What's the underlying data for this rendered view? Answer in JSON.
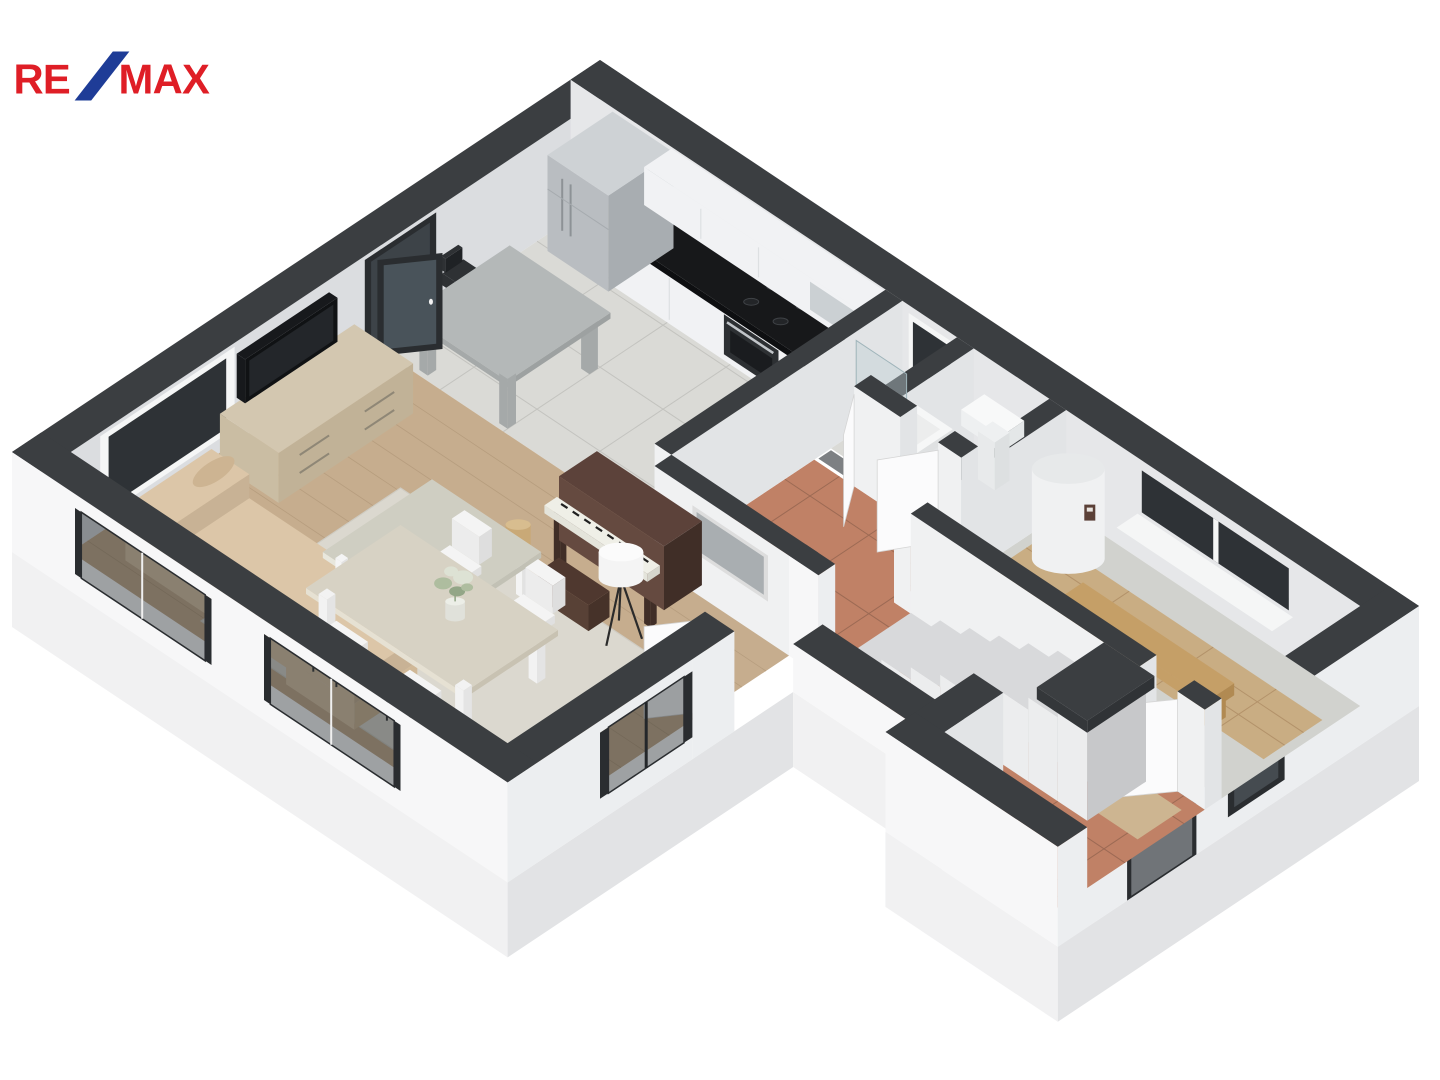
{
  "page": {
    "background": "#ffffff",
    "type": "3d-floorplan-render"
  },
  "logo": {
    "re": "RE",
    "slash": "/",
    "max": "MAX",
    "red": "#df1e26",
    "blue": "#1e3c97"
  },
  "palette": {
    "bg": "#ffffff",
    "wall_cap": "#3b3e41",
    "int_sw": "#f0f1f2",
    "int_se": "#e2e4e6",
    "inner_back_sw": "#e6e7e9",
    "inner_back_se": "#dbdde0",
    "out_sw": "#f7f7f8",
    "out_se": "#eceef0",
    "slab_sw": "#f1f1f2",
    "slab_se": "#e2e3e5",
    "glass": "#2e3236",
    "glass_tint": "rgba(24,30,35,0.42)",
    "frame_white": "#f5f6f6",
    "door_frame": "#2a2d30",
    "floor_tile": "#dadad6",
    "tile_grout": "#c3c3bf",
    "terracotta": "#c08166",
    "terracotta_grout": "#9c6a54",
    "wood": "#c6ad8e",
    "wood_line": "#b69d7e",
    "concrete": "#d1d2ce",
    "wood_path": "#c9ad83",
    "wood_path_line": "#b3926a",
    "stair_top": "#d8d9db",
    "stair_face": "#ecedee",
    "stair_side": "#c7c8ca",
    "counter_black": "#17181a",
    "counter_face": "#0e0f11",
    "cabinet": "#f1f2f4",
    "cabinet_seam": "#dde0e2",
    "steel": "#b9bdc1",
    "steel_side": "#a8adb1",
    "steel_top": "#ced2d5",
    "island": "#b4b8b8",
    "island_side": "#a5a9a9",
    "stool_dark": "#2e3134",
    "chrome": "#c6cacd",
    "sofa": "#dcc6a8",
    "sofa_dark": "#d0b897",
    "sofa_roll": "#cdb492",
    "rug": "#dbd8cf",
    "rug_edge": "#cfccc3",
    "table_pale": "#d7d2c4",
    "table_edge": "#c8c2b2",
    "coffee": "#cfcec2",
    "leg_white": "#f4f4f4",
    "dresser": "#d3c7b0",
    "dresser_face": "#cabda3",
    "dresser_end": "#c1b297",
    "handle": "#8f8776",
    "tv": "#17191c",
    "tv_screen": "#23262a",
    "piano": "#5c423a",
    "piano_face": "#654a40",
    "piano_dark": "#402e27",
    "keys": "#efefe7",
    "bench": "#4f382f",
    "lamp": "#f4f4f4",
    "shelf": "#c59f67",
    "shelf_side": "#b18a52",
    "boiler": "#f0f1f2",
    "boiler_side": "#dcdfe1",
    "boiler_top": "#e7e9ea",
    "door_leaf": "#fbfbfc",
    "door_edge": "#d5d5d5",
    "entry_door": "#707478",
    "mat": "#cdb591",
    "picture": "#a9aeb1",
    "picture_frame": "#dddddd",
    "plant1": "#aebd9f",
    "plant2": "#dde2d4",
    "plant3": "#93a687",
    "vase": "#e0e1da",
    "threshold": "#7d8083"
  },
  "floorplan": {
    "view": "isometric-3d-cutaway",
    "rooms": [
      {
        "name": "kitchen",
        "floor": "gray-ceramic-tile"
      },
      {
        "name": "shower-room",
        "floor": "gray-ceramic-tile"
      },
      {
        "name": "wc",
        "floor": "gray-ceramic-tile"
      },
      {
        "name": "hallway",
        "floor": "terracotta-tile"
      },
      {
        "name": "staircase",
        "steps": 8
      },
      {
        "name": "technical-room",
        "floor": "concrete-with-wood-walkway"
      },
      {
        "name": "entry-vestibule",
        "floor": "terracotta-tile"
      },
      {
        "name": "living-dining-room",
        "floor": "light-oak-planks"
      }
    ],
    "furniture": [
      "refrigerator",
      "kitchen-counter-black-top",
      "oven-cooktop",
      "wall-cabinets",
      "bar-table",
      "bar-stools",
      "shower-tray",
      "wash-basin",
      "water-heater",
      "wall-shelf",
      "tv-dresser",
      "television",
      "daybed-sofa",
      "armchair",
      "coffee-table",
      "rug",
      "upright-piano",
      "piano-bench",
      "wood-stool",
      "floor-lamp",
      "dining-table",
      "dining-chairs",
      "flower-vase",
      "doormat",
      "wall-picture"
    ],
    "openings": [
      "balcony-glass-door",
      "living-window-nw",
      "sw-window-1",
      "sw-window-2",
      "se-living-window",
      "shower-window",
      "technical-room-window",
      "entry-door",
      "entry-window",
      "interior-doors"
    ]
  }
}
